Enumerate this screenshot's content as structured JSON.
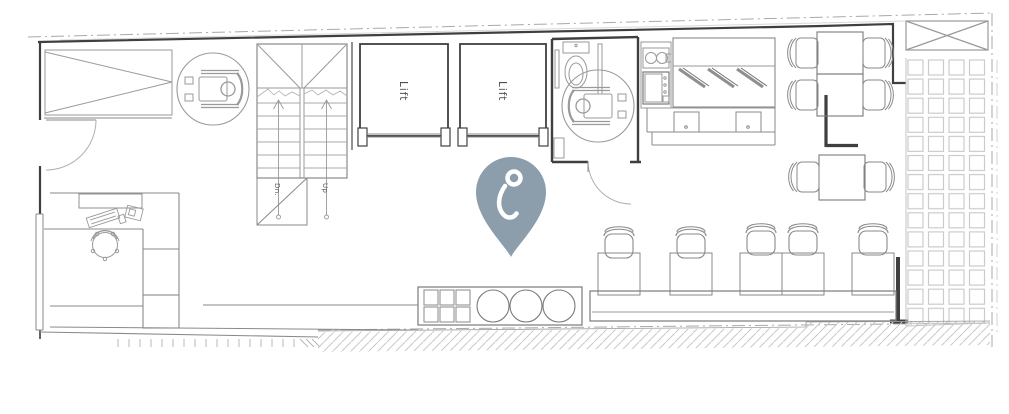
{
  "floor_plan": {
    "lifts": [
      {
        "label": "Lift"
      },
      {
        "label": "Lift"
      }
    ],
    "stairs": {
      "down_label": "Dn.",
      "up_label": "Up"
    },
    "marker": {
      "pin_color": "#8C9DAB",
      "glyph_color": "#FFFFFF"
    },
    "colors": {
      "background": "#FFFFFF",
      "wall_dark": "#3F3F3F",
      "wall_medium": "#6E6E6E",
      "line": "#8A8A8A",
      "line_light": "#B9BCBE",
      "hatch": "#C6C8CA",
      "boundary": "#A9A9A9"
    },
    "symbol_counts": {
      "wheelchair_symbols": 2,
      "dining_chairs": 6,
      "bar_stools": 5,
      "window_seats": 3
    }
  }
}
